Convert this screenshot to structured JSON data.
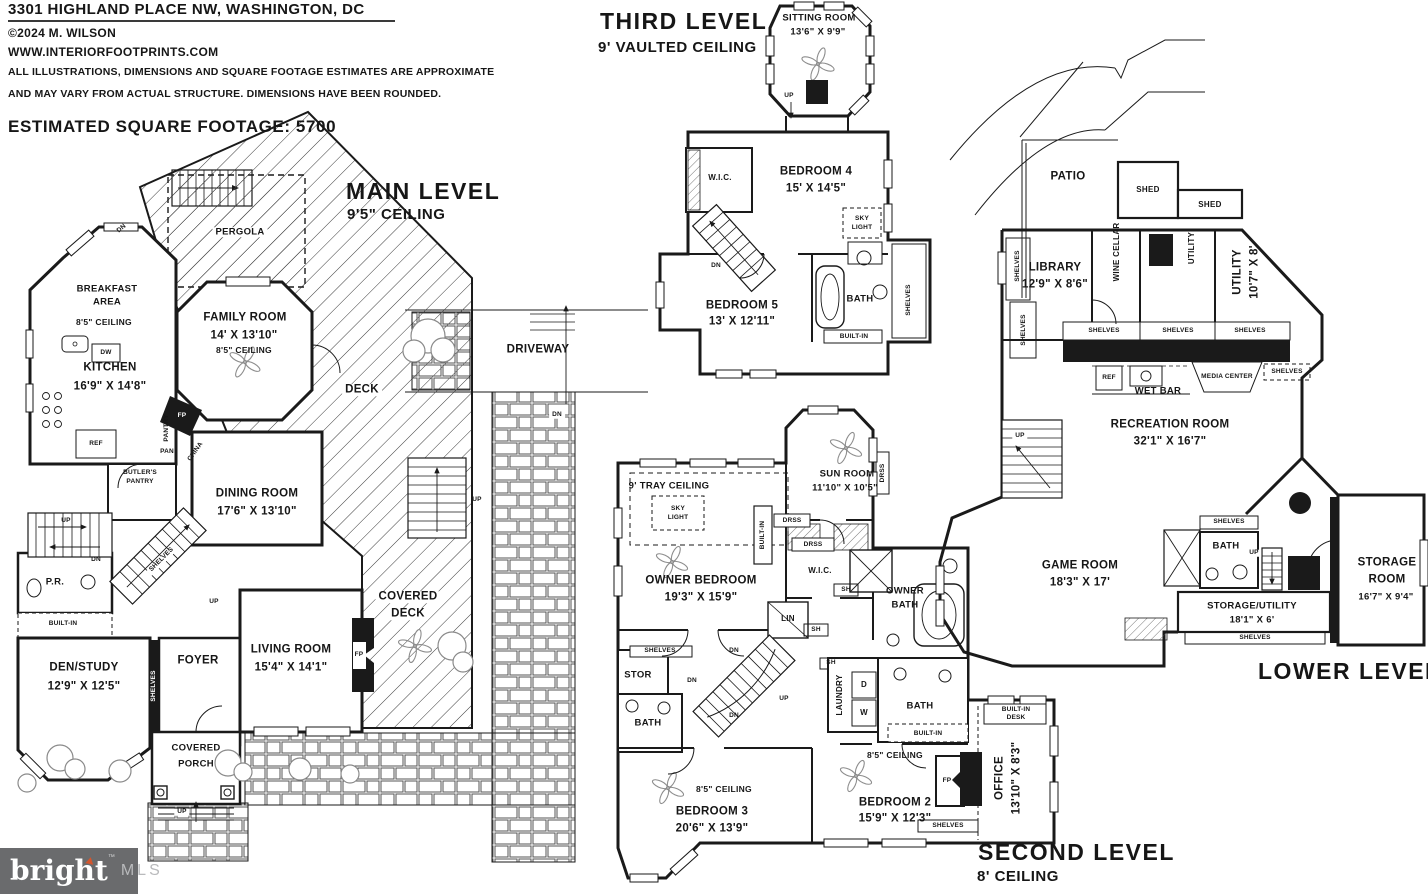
{
  "header": {
    "address": "3301 HIGHLAND PLACE NW, WASHINGTON, DC",
    "copyright": "©2024 M. WILSON",
    "website": "WWW.INTERIORFOOTPRINTS.COM",
    "disclaimer1": "ALL ILLUSTRATIONS, DIMENSIONS AND SQUARE FOOTAGE ESTIMATES ARE APPROXIMATE",
    "disclaimer2": "AND MAY VARY FROM ACTUAL STRUCTURE. DIMENSIONS HAVE BEEN ROUNDED.",
    "sqft": "ESTIMATED SQUARE FOOTAGE: 5700"
  },
  "levels": {
    "main": {
      "title": "MAIN LEVEL",
      "ceiling": "9'5\" CEILING"
    },
    "third": {
      "title": "THIRD LEVEL",
      "ceiling": "9' VAULTED CEILING"
    },
    "second": {
      "title": "SECOND LEVEL",
      "ceiling": "8' CEILING"
    },
    "lower": {
      "title": "LOWER LEVEL"
    }
  },
  "rooms": {
    "pergola": "PERGOLA",
    "breakfast1": "BREAKFAST",
    "breakfast2": "AREA",
    "kitchen": "KITCHEN",
    "kitchen_dims": "16'9\" X 14'8\"",
    "family": "FAMILY ROOM",
    "family_dims": "14' X 13'10\"",
    "deck": "DECK",
    "driveway": "DRIVEWAY",
    "dining": "DINING ROOM",
    "dining_dims": "17'6\" X 13'10\"",
    "butlers1": "BUTLER'S",
    "butlers2": "PANTRY",
    "pr": "P.R.",
    "den": "DEN/STUDY",
    "den_dims": "12'9\" X 12'5\"",
    "foyer": "FOYER",
    "living": "LIVING ROOM",
    "living_dims": "15'4\" X 14'1\"",
    "covered": "COVERED",
    "covered_deck2": "DECK",
    "covered_porch2": "PORCH",
    "sitting": "SITTING ROOM",
    "sitting_dims": "13'6\" X 9'9\"",
    "bed4": "BEDROOM 4",
    "bed4_dims": "15' X 14'5\"",
    "bed5": "BEDROOM 5",
    "bed5_dims": "13' X 12'11\"",
    "tray": "9' TRAY CEILING",
    "sun": "SUN ROOM",
    "sun_dims": "11'10\" X 10'5\"",
    "owner_bed": "OWNER BEDROOM",
    "owner_bed_dims": "19'3\" X 15'9\"",
    "owner1": "OWNER",
    "owner2": "BATH",
    "bed3": "BEDROOM 3",
    "bed3_dims": "20'6\" X 13'9\"",
    "bed2": "BEDROOM 2",
    "bed2_dims": "15'9\" X 12'3\"",
    "office": "OFFICE",
    "office_dims": "13'10\" X 8'3\"",
    "patio": "PATIO",
    "shed": "SHED",
    "library": "LIBRARY",
    "library_dims": "12'9\" X 8'6\"",
    "wine": "WINE CELLAR",
    "utility": "UTILITY",
    "utility2_dims": "10'7\" X 8'",
    "wet_bar": "WET BAR",
    "media": "MEDIA CENTER",
    "rec": "RECREATION ROOM",
    "rec_dims": "32'1\" X 16'7\"",
    "game": "GAME ROOM",
    "game_dims": "18'3\" X 17'",
    "storage_utility": "STORAGE/UTILITY",
    "storage_utility_dims": "18'1\" X 6'",
    "storage1": "STORAGE",
    "storage2": "ROOM",
    "storage_dims": "16'7\" X 9'4\""
  },
  "tags": {
    "up": "UP",
    "dn": "DN",
    "shelves": "SHELVES",
    "built_in": "BUILT-IN",
    "built_in_desk1": "BUILT-IN",
    "built_in_desk2": "DESK",
    "fp": "FP",
    "ref": "REF",
    "dw": "DW",
    "sh": "SH",
    "sky1": "SKY",
    "sky2": "LIGHT",
    "bath": "BATH",
    "wic": "W.I.C.",
    "ceiling85": "8'5\" CEILING",
    "d": "D",
    "w": "W",
    "drss": "DRSS",
    "pan": "PAN",
    "pantry": "PANTRY",
    "china": "CHINA",
    "lin": "LIN",
    "stor": "STOR",
    "laundry": "LAUNDRY"
  },
  "logo": {
    "brand": "bright",
    "tm": "™",
    "suffix": "MLS"
  },
  "colors": {
    "line": "#1a1a1a",
    "logo_bg": "#6a6b6d",
    "logo_mls": "#b9babc",
    "accent": "#d4562e"
  }
}
